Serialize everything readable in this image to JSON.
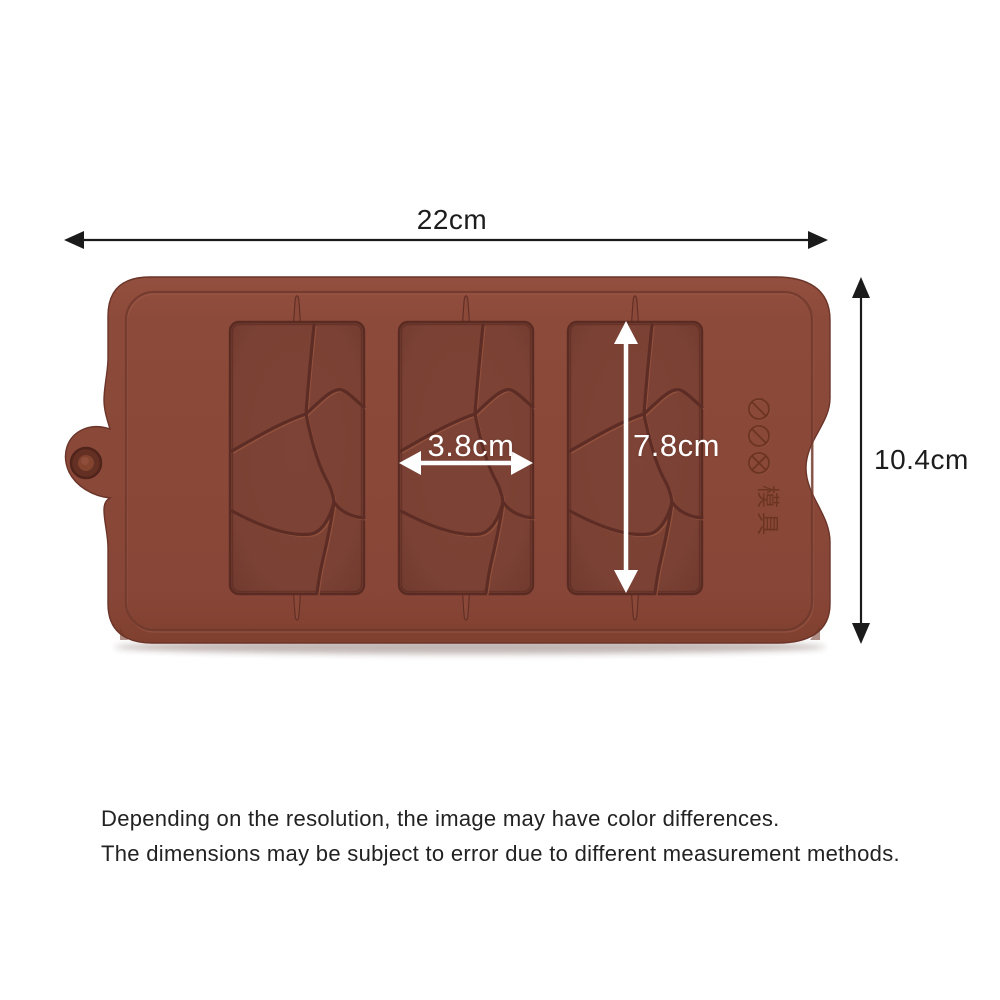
{
  "page": {
    "background": "#ffffff",
    "type": "product dimension diagram"
  },
  "annotations": {
    "overall_width": "22cm",
    "overall_height": "10.4cm",
    "cavity_width": "3.8cm",
    "cavity_height": "7.8cm"
  },
  "disclaimer": {
    "line1": "Depending on the resolution, the image may have color differences.",
    "line2": "The dimensions may be subject to error due to different measurement methods."
  },
  "product": {
    "name": "3-cavity broken-chunk chocolate bar silicone mold",
    "cavity_count": 3,
    "embossed_icons": [
      "prohibition-icon",
      "prohibition-icon",
      "cross-circle-icon"
    ],
    "embossed_characters": "模具"
  },
  "colors": {
    "mold_body": "#8a4839",
    "mold_body_light": "#96523f",
    "mold_cavity": "#7a4134",
    "cavity_edge": "#5a2b22",
    "crack_line": "#5d2d25",
    "crack_highlight": "#96543f",
    "groove_line": "#6e382c",
    "tab_ring": "#5f2d24",
    "dimension_arrow": "#1b1b1b",
    "inner_arrow": "#ffffff",
    "disclaimer_text": "#222222"
  }
}
